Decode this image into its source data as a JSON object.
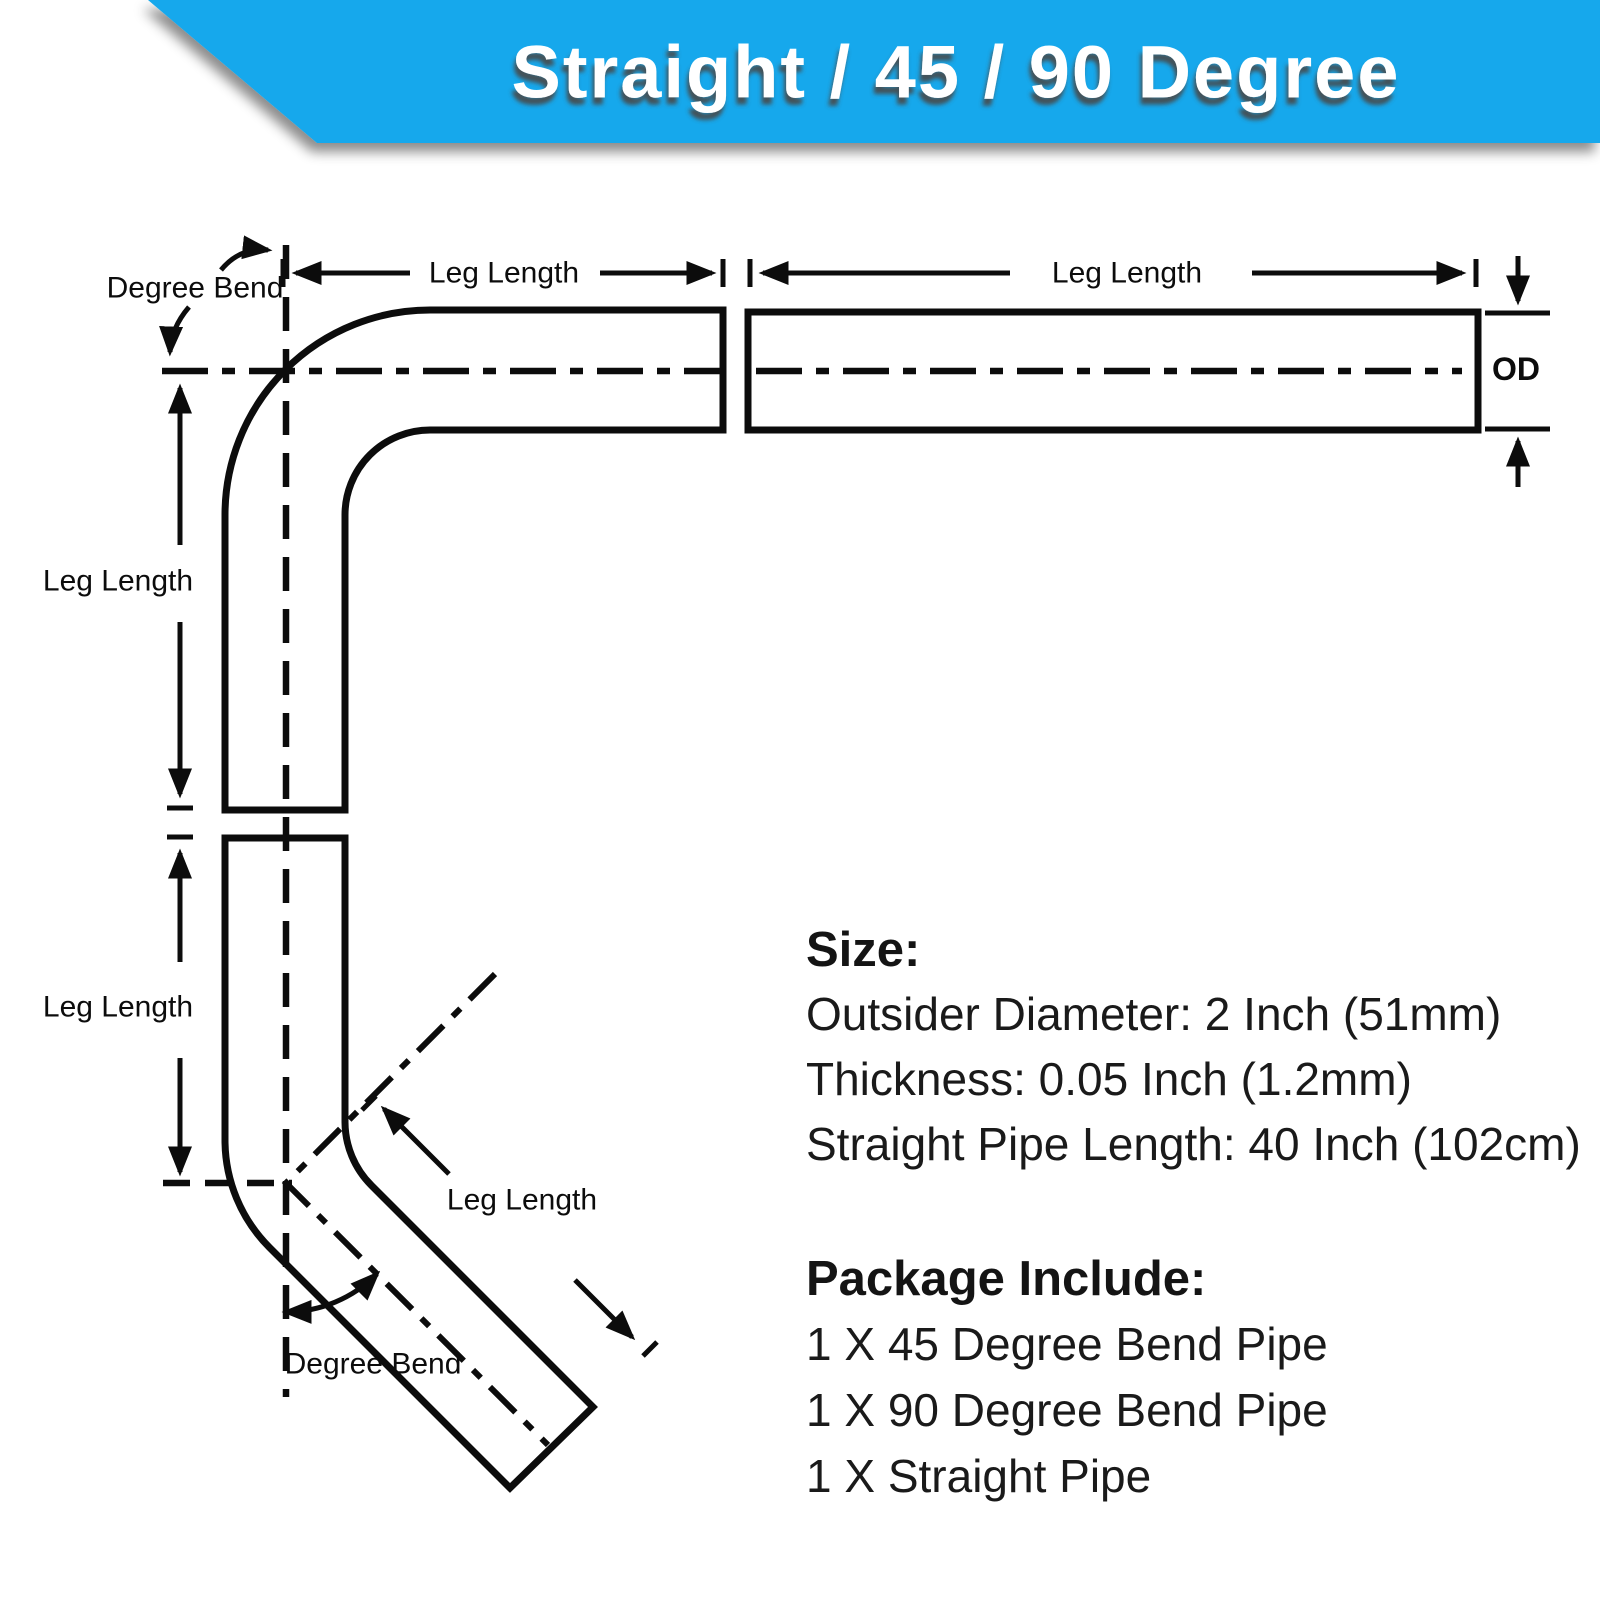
{
  "banner": {
    "title": "Straight / 45 / 90 Degree",
    "background_color": "#16A8EC"
  },
  "labels": {
    "degree_bend_top": "Degree Bend",
    "degree_bend_bottom": "Degree Bend",
    "leg_length_top_left": "Leg Length",
    "leg_length_top_right": "Leg Length",
    "leg_length_side_90": "Leg Length",
    "leg_length_side_45": "Leg Length",
    "leg_length_diagonal": "Leg Length",
    "od": "OD"
  },
  "size_section": {
    "heading": "Size:",
    "lines": [
      "Outsider Diameter: 2 Inch (51mm)",
      "Thickness: 0.05 Inch (1.2mm)",
      "Straight Pipe Length: 40 Inch  (102cm)"
    ]
  },
  "package_section": {
    "heading": "Package Include:",
    "items": [
      "1 X 45 Degree Bend Pipe",
      "1 X 90 Degree Bend Pipe",
      "1 X Straight Pipe"
    ]
  }
}
